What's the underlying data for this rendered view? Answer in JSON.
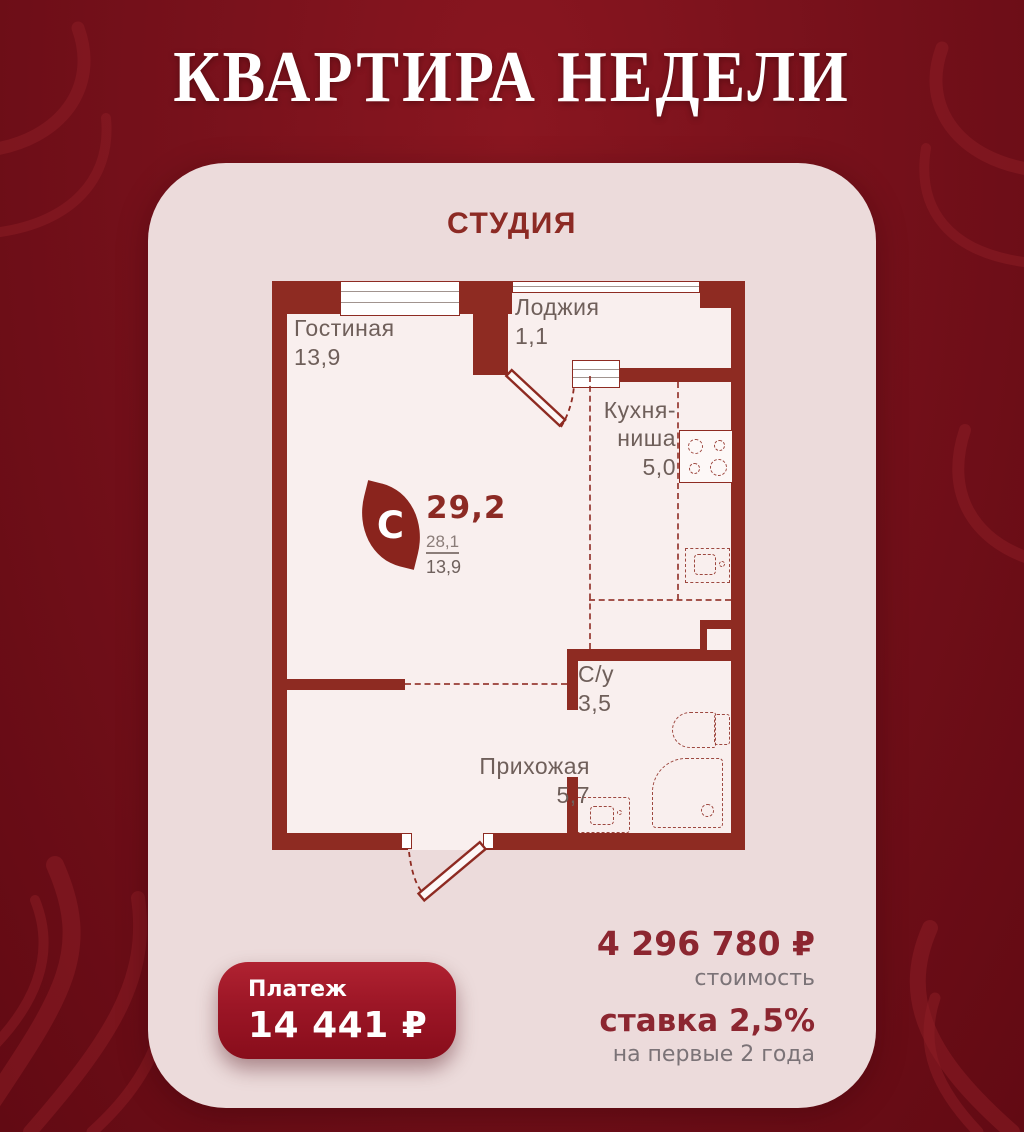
{
  "title": "КВАРТИРА НЕДЕЛИ",
  "card": {
    "type_label": "СТУДИЯ"
  },
  "plan": {
    "rooms": {
      "living": {
        "name": "Гостиная",
        "area": "13,9"
      },
      "loggia": {
        "name": "Лоджия",
        "area": "1,1"
      },
      "kitchen": {
        "name_line1": "Кухня-",
        "name_line2": "ниша",
        "area": "5,0"
      },
      "bathroom": {
        "name": "С/у",
        "area": "3,5"
      },
      "hallway": {
        "name": "Прихожая",
        "area": "5,7"
      }
    },
    "summary": {
      "total_area": "29,2",
      "area_no_loggia": "28,1",
      "living_area": "13,9"
    },
    "logo_letter": "C"
  },
  "footer": {
    "payment": {
      "label": "Платеж",
      "value": "14 441 ₽"
    },
    "price": {
      "value": "4 296 780 ₽",
      "label": "стоимость"
    },
    "rate": {
      "value": "ставка 2,5%",
      "label": "на первые 2 года"
    }
  },
  "colors": {
    "background": "#77111b",
    "card": "#ecdbdb",
    "plan_floor": "#f9efee",
    "wall": "#8e2b22",
    "accent_dark_red": "#8c2a24",
    "price_red": "#8c2630",
    "muted_gray": "#7b7377",
    "room_label": "#6f5f5a",
    "button_red": "#9c1626",
    "white": "#ffffff"
  }
}
